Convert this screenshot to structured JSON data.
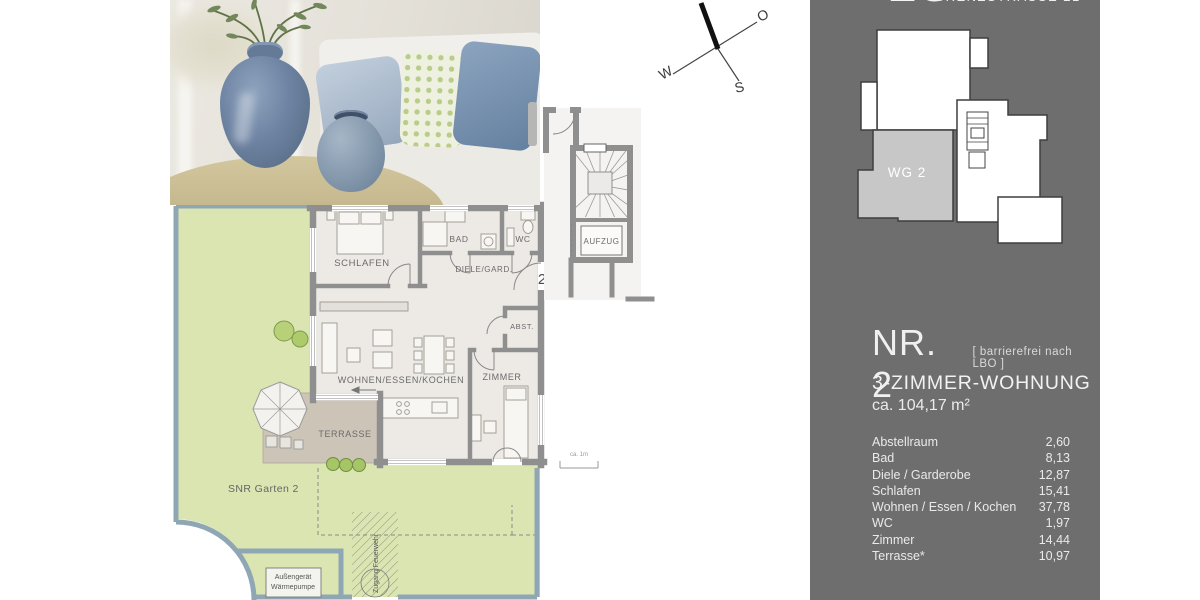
{
  "colors": {
    "sidebar_bg": "#6e6e6e",
    "garden_green": "#dbe5b2",
    "fence_blue": "#8fa7b4",
    "terrace_tan": "#cdc4b8",
    "wall_gray": "#8f8f8f",
    "room_floor": "#edeae6",
    "minimap_unit_fill": "#c7c7c7",
    "text_light": "#efefef",
    "label_gray": "#6b6b6b"
  },
  "sidebar": {
    "floor_label": "EG",
    "street": "GRENZSTRASSE 21",
    "minimap_unit_label": "WG 2",
    "unit": {
      "number": "NR. 2",
      "note": "[ barrierefrei nach LBO ]",
      "type": "3-ZIMMER-WOHNUNG",
      "area": "ca. 104,17 m²"
    },
    "rooms": [
      {
        "label": "Abstellraum",
        "value": "2,60"
      },
      {
        "label": "Bad",
        "value": "8,13"
      },
      {
        "label": "Diele / Garderobe",
        "value": "12,87"
      },
      {
        "label": "Schlafen",
        "value": "15,41"
      },
      {
        "label": "Wohnen / Essen / Kochen",
        "value": "37,78"
      },
      {
        "label": "WC",
        "value": "1,97"
      },
      {
        "label": "Zimmer",
        "value": "14,44"
      },
      {
        "label": "Terrasse*",
        "value": "10,97"
      }
    ]
  },
  "compass": {
    "east": "O",
    "south": "S",
    "west": "W"
  },
  "floorplan": {
    "labels": {
      "schlafen": "SCHLAFEN",
      "bad": "BAD",
      "wc": "WC",
      "diele": "DIELE/GARD.",
      "abst": "ABST.",
      "wohnen": "WOHNEN/ESSEN/KOCHEN",
      "zimmer": "ZIMMER",
      "terrasse": "TERRASSE",
      "aufzug": "AUFZUG"
    },
    "annotations": {
      "unit_door_number": "2",
      "garden": "SNR Garten 2",
      "heat_pump_line1": "Außengerät",
      "heat_pump_line2": "Wärmepumpe",
      "fire_access": "Zugang Feuerwehr",
      "scale": "ca. 1m"
    }
  }
}
